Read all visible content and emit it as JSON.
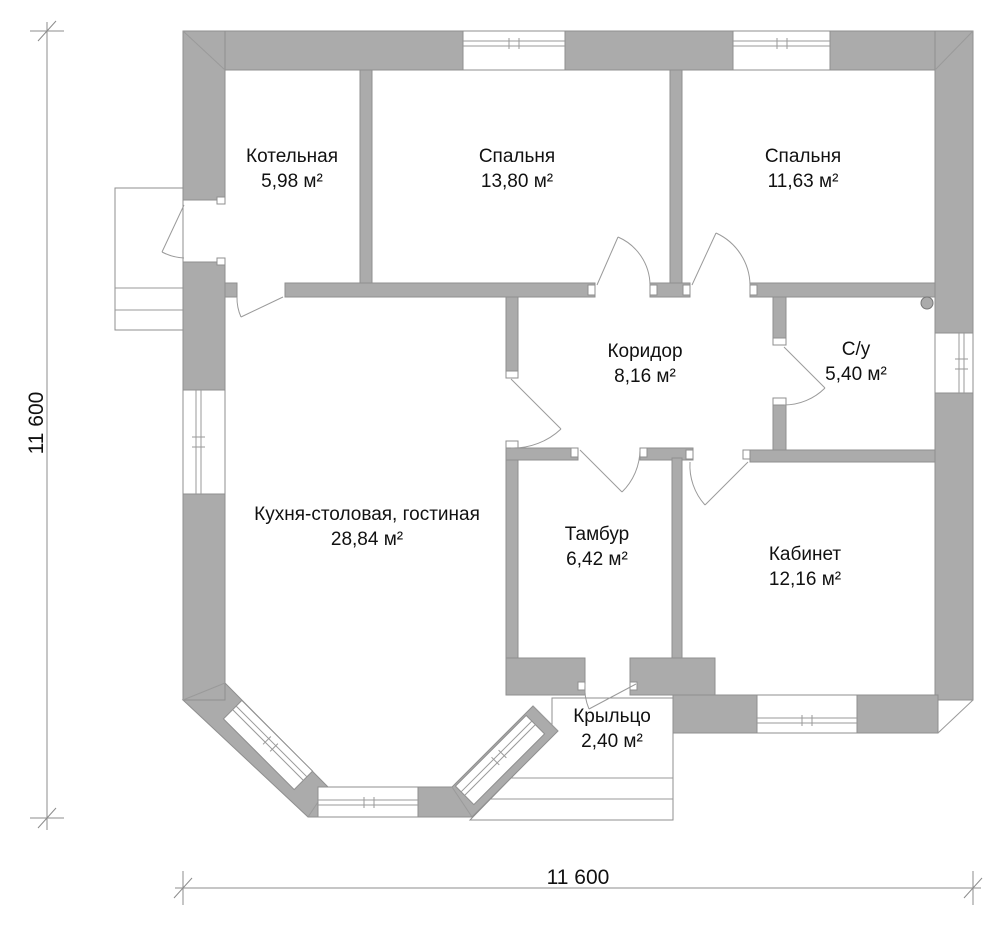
{
  "plan": {
    "rooms": [
      {
        "id": "kotelnaya",
        "name": "Котельная",
        "area": "5,98 м²"
      },
      {
        "id": "bedroom1",
        "name": "Спальня",
        "area": "13,80 м²"
      },
      {
        "id": "bedroom2",
        "name": "Спальня",
        "area": "11,63 м²"
      },
      {
        "id": "koridor",
        "name": "Коридор",
        "area": "8,16 м²"
      },
      {
        "id": "su",
        "name": "С/у",
        "area": "5,40 м²"
      },
      {
        "id": "kitchen",
        "name": "Кухня-столовая, гостиная",
        "area": "28,84 м²"
      },
      {
        "id": "tambur",
        "name": "Тамбур",
        "area": "6,42 м²"
      },
      {
        "id": "kabinet",
        "name": "Кабинет",
        "area": "12,16 м²"
      },
      {
        "id": "krylco",
        "name": "Крыльцо",
        "area": "2,40 м²"
      }
    ],
    "dimensions": {
      "left": "11 600",
      "bottom": "11 600"
    },
    "colors": {
      "wall": "#ababab",
      "wall_outline": "#8f8f8f",
      "line": "#9a9a9a",
      "text": "#111111",
      "background": "#ffffff"
    }
  }
}
